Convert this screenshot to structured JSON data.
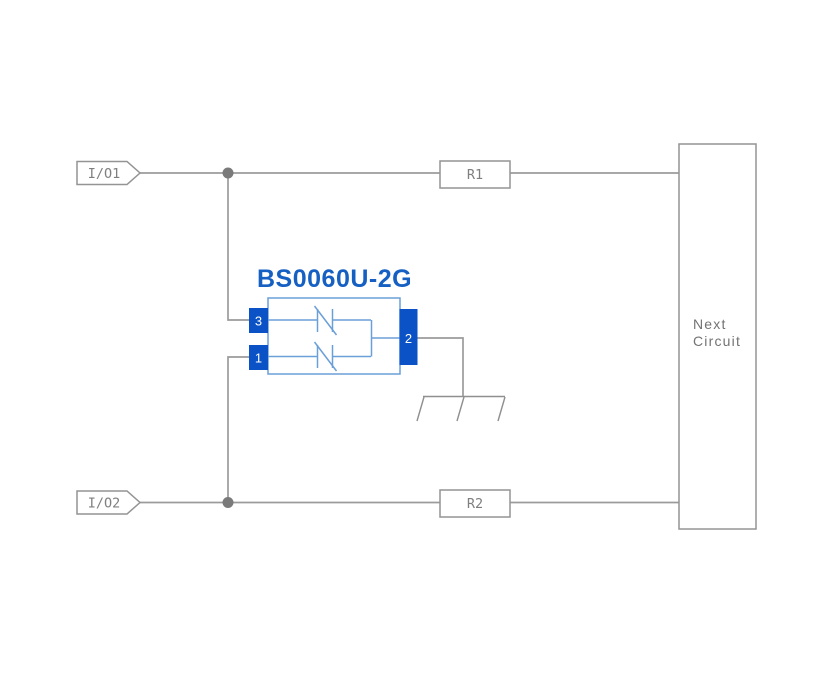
{
  "diagram": {
    "component": {
      "title": "BS0060U-2G",
      "pins": {
        "top_left": "3",
        "bottom_left": "1",
        "right": "2"
      }
    },
    "io_ports": [
      {
        "label": "I/O1"
      },
      {
        "label": "I/O2"
      }
    ],
    "resistors": [
      {
        "label": "R1"
      },
      {
        "label": "R2"
      }
    ],
    "next_circuit": {
      "line1": "Next",
      "line2": "Circuit"
    },
    "icons": {
      "ground": "chassis-ground-icon",
      "junction": "junction-dot"
    },
    "colors": {
      "background": "#ffffff",
      "wire_gray": "#9b9b9b",
      "outline_gray": "#949494",
      "junction_gray": "#7a7a7a",
      "label_gray": "#7f7f7f",
      "component_outline_blue": "#6b9fd8",
      "pin_fill_blue": "#0a52c6",
      "pin_text_white": "#ffffff",
      "title_blue": "#1560c2"
    }
  }
}
